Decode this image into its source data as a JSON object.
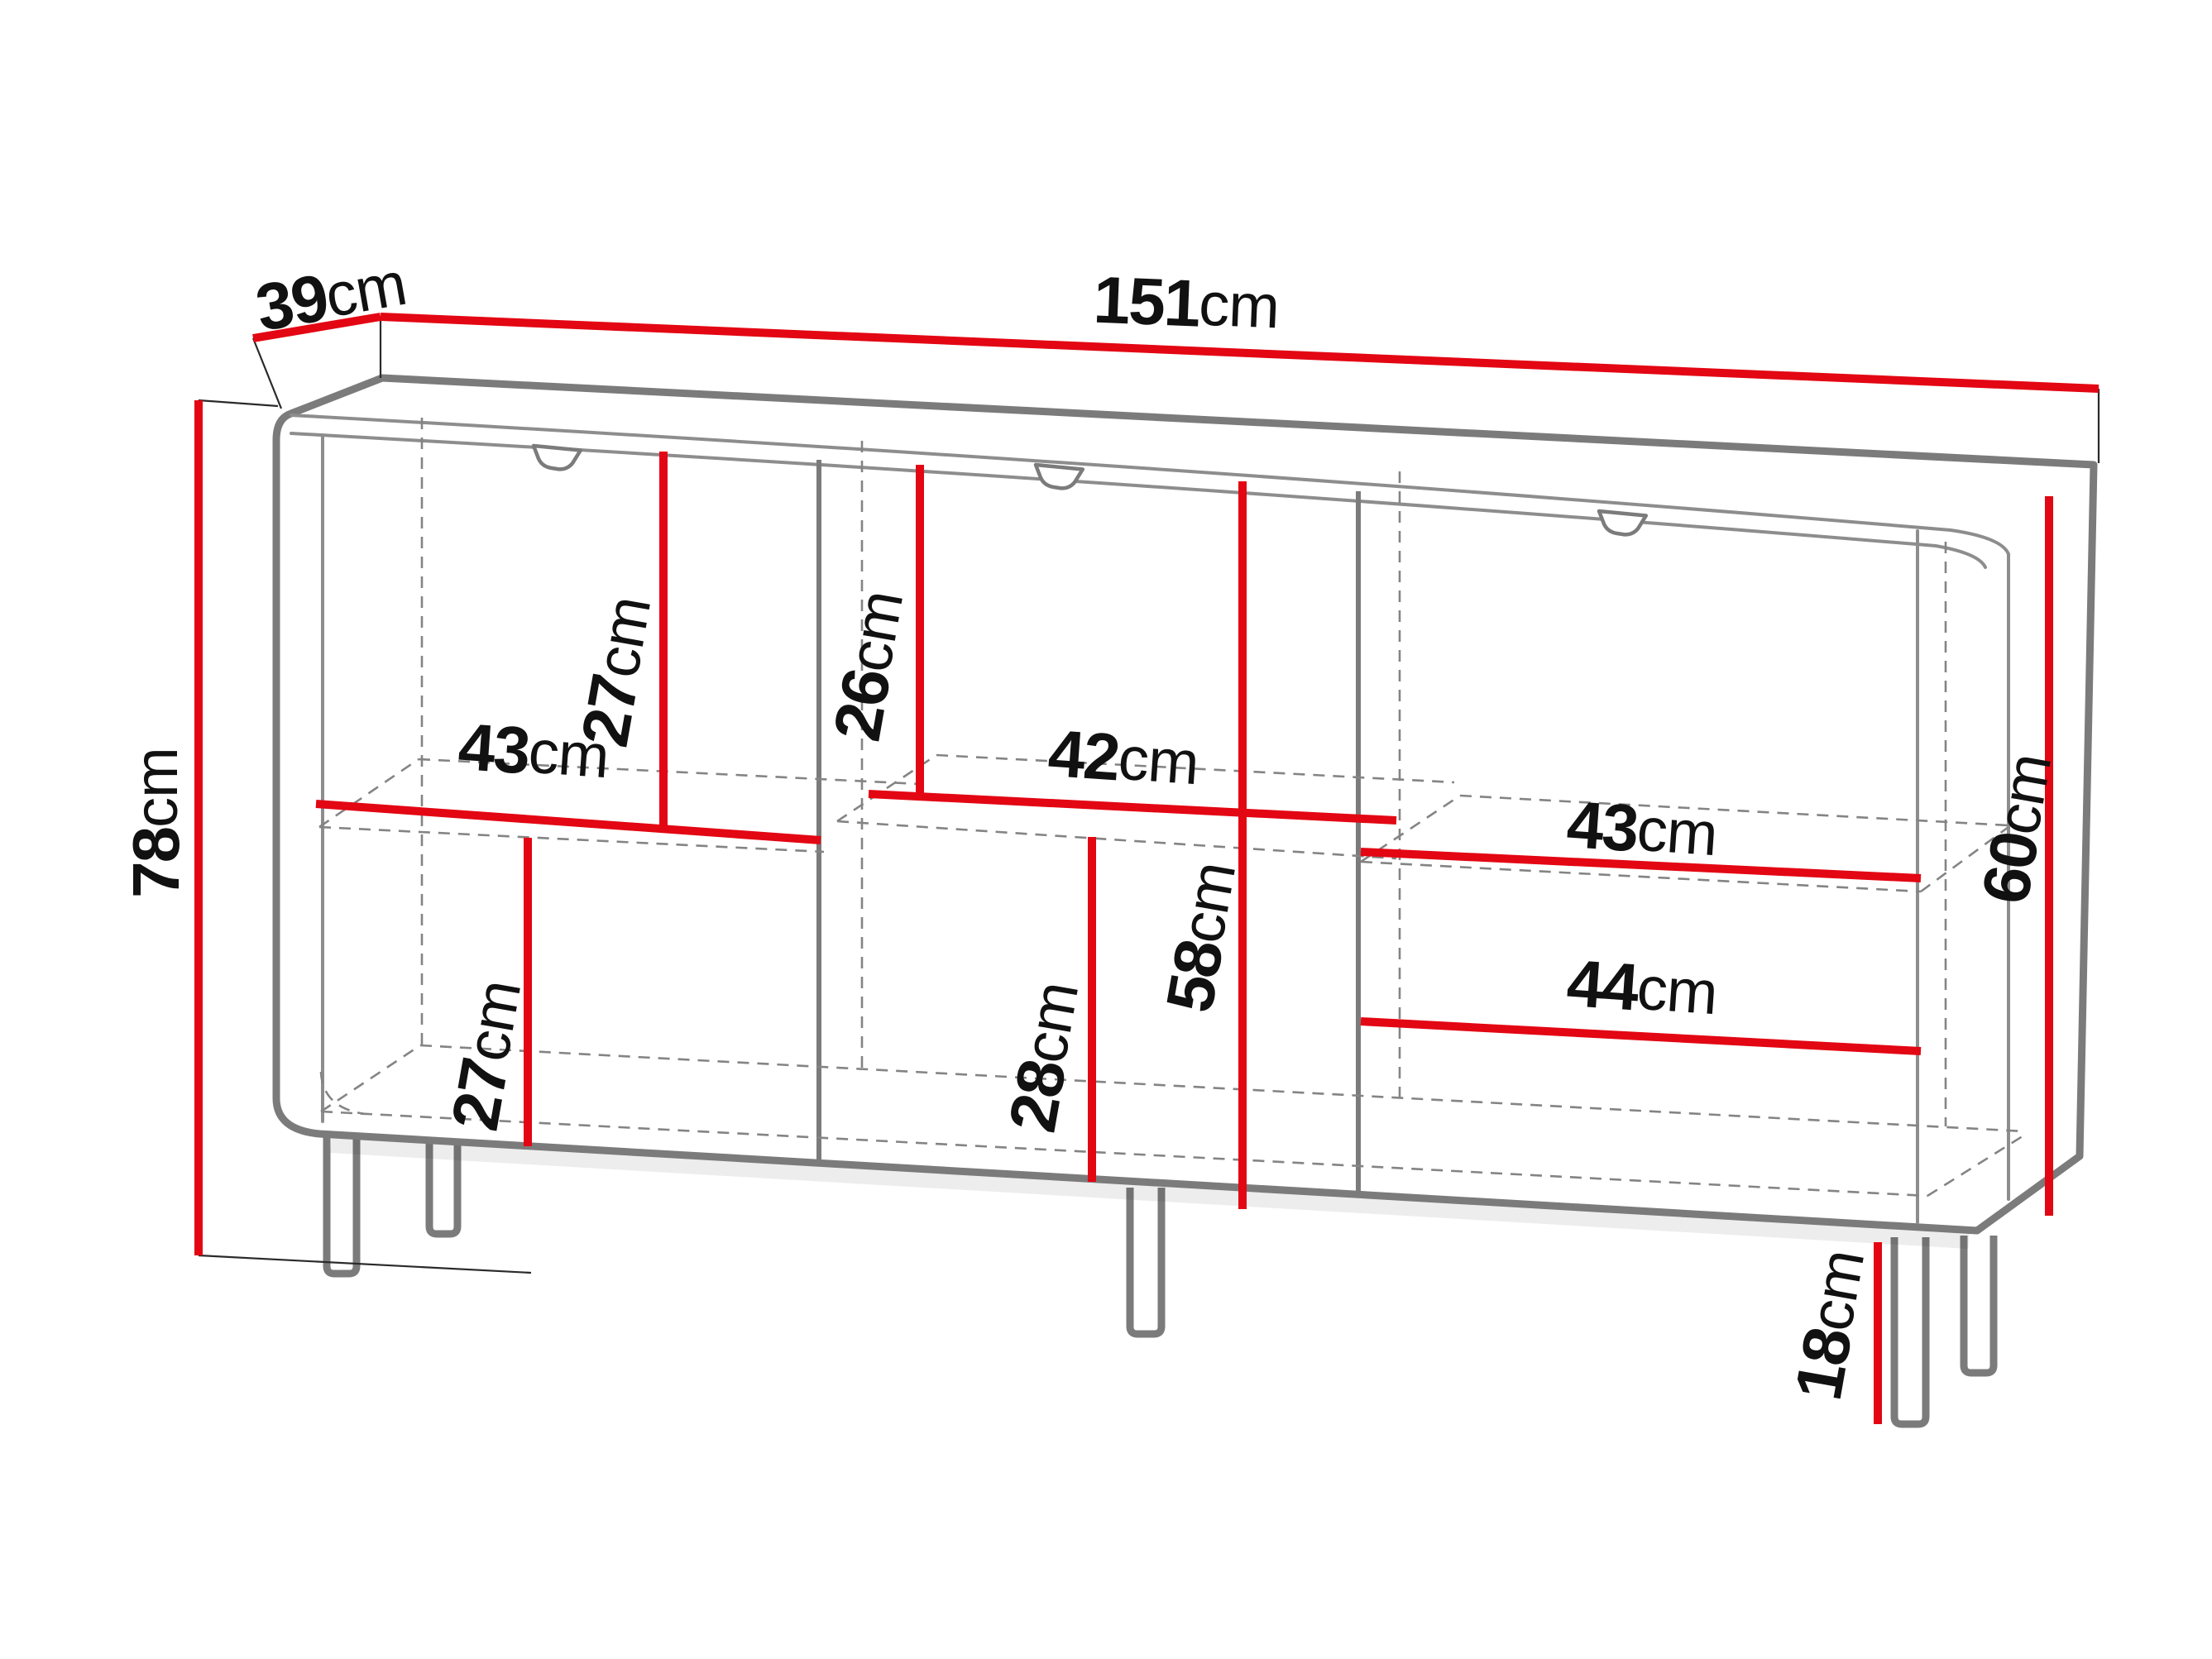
{
  "diagram": {
    "kind": "furniture-dimension-diagram",
    "subject": "sideboard cabinet with three sections, interior shelves and legs",
    "unit": "cm",
    "colors": {
      "dimension_line": "#e30613",
      "furniture_outline": "#7b7b7b",
      "label_text": "#111111",
      "background": "#ffffff"
    },
    "dims": {
      "depth": {
        "value": "39",
        "unit": "cm"
      },
      "width": {
        "value": "151",
        "unit": "cm"
      },
      "height": {
        "value": "78",
        "unit": "cm"
      },
      "left_upper_height": {
        "value": "27",
        "unit": "cm"
      },
      "left_shelf_width": {
        "value": "43",
        "unit": "cm"
      },
      "left_lower_height": {
        "value": "27",
        "unit": "cm"
      },
      "middle_upper_height": {
        "value": "26",
        "unit": "cm"
      },
      "middle_shelf_width": {
        "value": "42",
        "unit": "cm"
      },
      "middle_lower_height": {
        "value": "28",
        "unit": "cm"
      },
      "middle_interior_height": {
        "value": "58",
        "unit": "cm"
      },
      "right_shelf_width": {
        "value": "43",
        "unit": "cm"
      },
      "right_drawer_width": {
        "value": "44",
        "unit": "cm"
      },
      "right_interior_height": {
        "value": "60",
        "unit": "cm"
      },
      "leg_height": {
        "value": "18",
        "unit": "cm"
      }
    }
  }
}
